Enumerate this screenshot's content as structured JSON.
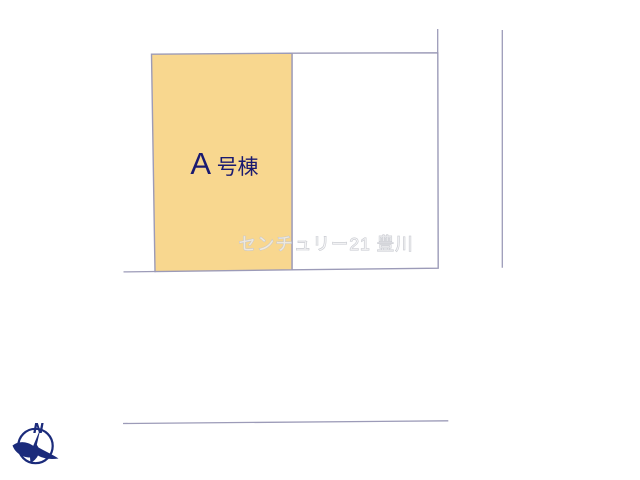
{
  "plan": {
    "lot_a": {
      "label": "A号棟",
      "label_prefix": "A",
      "label_suffix": "号棟",
      "fill": "#F8D78F",
      "text_color": "#1A1A70"
    },
    "lot_b": {
      "fill": "#FFFFFF"
    },
    "watermark": {
      "text": "センチュリー21 豊川",
      "color": "#CDCFD6"
    },
    "compass": {
      "north_label": "N",
      "color": "#1B2B7B"
    },
    "line_color": "#9C9BB8"
  }
}
